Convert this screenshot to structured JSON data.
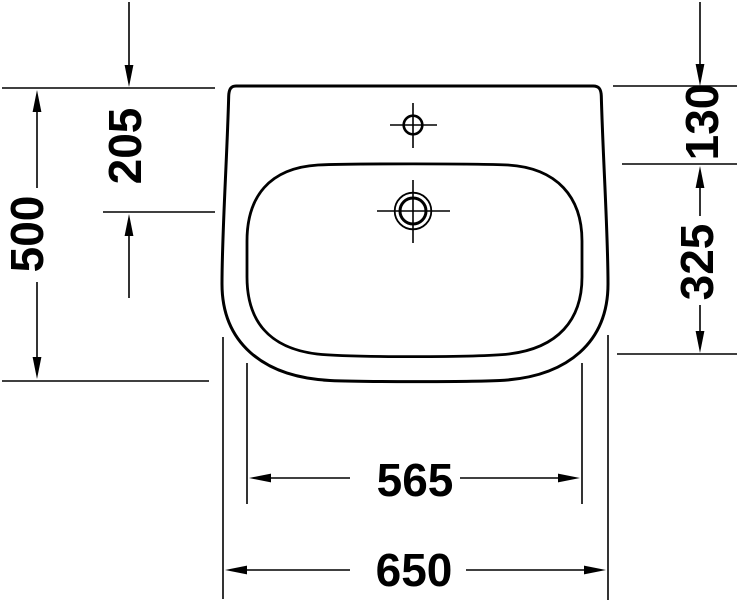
{
  "diagram": {
    "type": "technical-drawing",
    "subject": "washbasin top view with dimension lines",
    "colors": {
      "line": "#000000",
      "background": "#ffffff"
    },
    "features": {
      "faucet_hole": "faucet-hole-with-centerlines",
      "drain_hole": "drain-hole-with-centerlines"
    },
    "dimensions": {
      "depth_overall": "500",
      "back_edge_to_drain_center": "205",
      "back_edge_to_bowl_rim": "130",
      "bowl_front_to_back": "325",
      "bowl_width": "565",
      "width_overall": "650"
    }
  }
}
